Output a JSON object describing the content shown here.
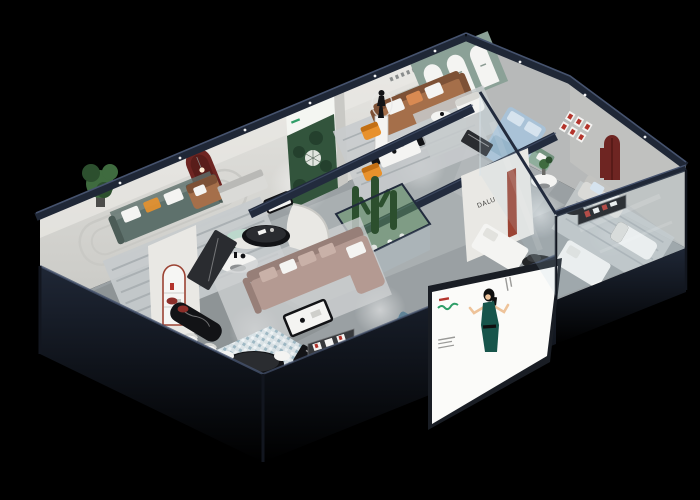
{
  "palette": {
    "bg": "#000000",
    "navy": "#1f2736",
    "navyDark": "#12161f",
    "navyEdge": "#46536e",
    "navyBeam": "#222b3d",
    "wallWhite": "#e9e8e4",
    "wallShade": "#c9c9c5",
    "wallGray": "#b7b9b9",
    "floor": "#9aa0a3",
    "floorLight": "#c6cacc",
    "floorDim": "#75797c",
    "rug": "#c7cbcd",
    "rugStripe": "#aab0b3",
    "sage": "#8ba197",
    "sageDark": "#5d7a6c",
    "forest": "#32543c",
    "forestDark": "#24402d",
    "poster": "#f4f6f2",
    "caramel": "#a56f4a",
    "caramelDark": "#7d5136",
    "greenSofa": "#5e716c",
    "mauve": "#b49a92",
    "mauveDark": "#977f78",
    "mauveLight": "#c9b1a8",
    "blueBed": "#a9c2d7",
    "bluePillow": "#d6e3ee",
    "slate": "#7698ab",
    "slateDark": "#5f8296",
    "orange": "#e8912c",
    "maroon": "#6e2522",
    "rust": "#9c4333",
    "red": "#b3342c",
    "blackFurn": "#121316",
    "glossBlack": "#2a2c30",
    "whiteFurn": "#f4f4f2",
    "grayFurn": "#dadad7",
    "plant": "#3f6b3f",
    "plantDark": "#2c4f2e",
    "mint": "#bcd8cc",
    "glass": "rgba(185,212,222,0.16)",
    "atrium": "rgba(92,140,96,0.55)",
    "billboard": "#fbfbf9",
    "billboardFrame": "#191d24",
    "bbGreen": "#2f9e68",
    "skin": "#eec39a",
    "dress": "#17554b",
    "hair": "#101010",
    "textGray": "#9a9a98",
    "lightGlow": "#ffffff",
    "mosaicBase": "#dbe4e8",
    "mosaicA": "#9db8c4",
    "mosaicB": "#f0f5f7",
    "signDark": "#37393c"
  },
  "scene": {
    "type": "isometric-showroom-cutaway-render",
    "partition_logo": "DALU",
    "rooms": [
      "left-living-room",
      "center-showroom",
      "sage-arch-lounge",
      "glass-bedroom",
      "right-sofa-room",
      "central-mauve-lounge",
      "cactus-atrium",
      "bar-area",
      "front-display-room"
    ],
    "features": [
      "black-background",
      "navy-cutaway-walls",
      "forest-poster",
      "red-arch-niche",
      "statue-pedestal",
      "glass-facade",
      "woman-billboard",
      "mosaic-rug",
      "marble-bar-counter",
      "red-framed-art",
      "maroon-arch-door"
    ]
  }
}
